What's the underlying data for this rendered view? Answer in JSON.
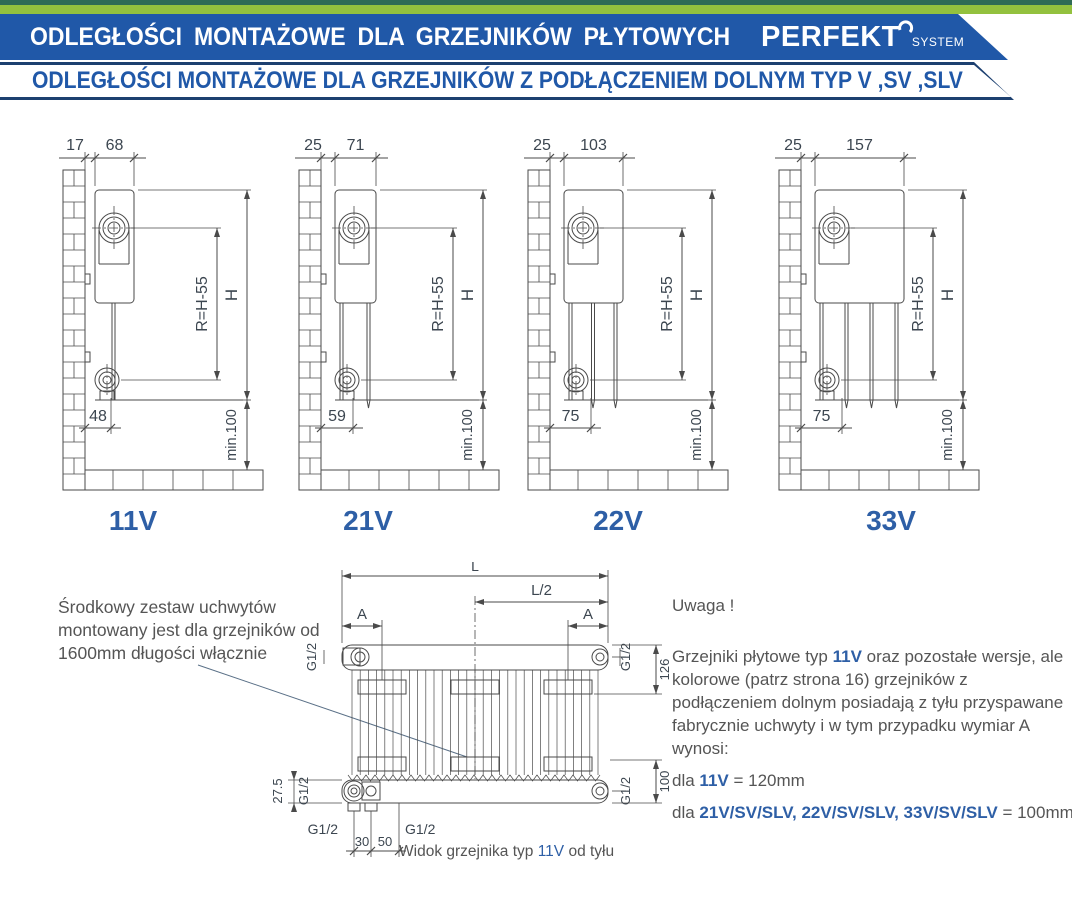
{
  "header": {
    "title": "ODLEGŁOŚCI MONTAŻOWE DLA GRZEJNIKÓW PŁYTOWYCH",
    "brand": "PERFEKT",
    "brand_sub": "SYSTEM",
    "subtitle": "ODLEGŁOŚCI MONTAŻOWE DLA GRZEJNIKÓW Z PODŁĄCZENIEM DOLNYM TYP V ,SV ,SLV"
  },
  "colors": {
    "banner_blue": "#2058a8",
    "accent_blue": "#2e5fa6",
    "green_strip": "#93c13e",
    "dark_green_strip": "#2f6b55",
    "line": "#4a4a4a",
    "dim_text": "#3c4650",
    "body_text": "#555555"
  },
  "diagrams": [
    {
      "label": "11V",
      "wall_gap": "17",
      "depth": "68",
      "radius_label": "R=H-55",
      "height_label": "H",
      "pipe_offset": "48",
      "floor_clearance": "min.100"
    },
    {
      "label": "21V",
      "wall_gap": "25",
      "depth": "71",
      "radius_label": "R=H-55",
      "height_label": "H",
      "pipe_offset": "59",
      "floor_clearance": "min.100"
    },
    {
      "label": "22V",
      "wall_gap": "25",
      "depth": "103",
      "radius_label": "R=H-55",
      "height_label": "H",
      "pipe_offset": "75",
      "floor_clearance": "min.100"
    },
    {
      "label": "33V",
      "wall_gap": "25",
      "depth": "157",
      "radius_label": "R=H-55",
      "height_label": "H",
      "pipe_offset": "75",
      "floor_clearance": "min.100"
    }
  ],
  "rear_view": {
    "length": "L",
    "half_length": "L/2",
    "bracket_offset": "A",
    "thread": "G1/2",
    "top_right_dim": "126",
    "bottom_right_dim": "100",
    "bottom_left_dim": "27.5",
    "conn_dim_1": "30",
    "conn_dim_2": "50",
    "caption": {
      "prefix": "Widok grzejnika typ ",
      "type": "11V",
      "suffix": " od tyłu"
    }
  },
  "notes": {
    "bracket_note": "Środkowy zestaw uchwytów montowany jest dla grzejników od 1600mm długości włącznie",
    "uwaga_title": "Uwaga !",
    "uwaga_p1": "Grzejniki płytowe typ ",
    "uwaga_p1_accent": "11V",
    "uwaga_p1_rest": " oraz pozostałe wersje, ale kolorowe (patrz strona 16) grzejników z podłączeniem dolnym posiadają z tyłu przyspawane fabrycznie uchwyty i w tym przypadku wymiar A wynosi:",
    "dla1_prefix": "dla ",
    "dla1_accent": "11V",
    "dla1_value": " = 120mm",
    "dla2_prefix": "dla ",
    "dla2_accent": "21V/SV/SLV, 22V/SV/SLV, 33V/SV/SLV",
    "dla2_value": " = 100mm"
  }
}
